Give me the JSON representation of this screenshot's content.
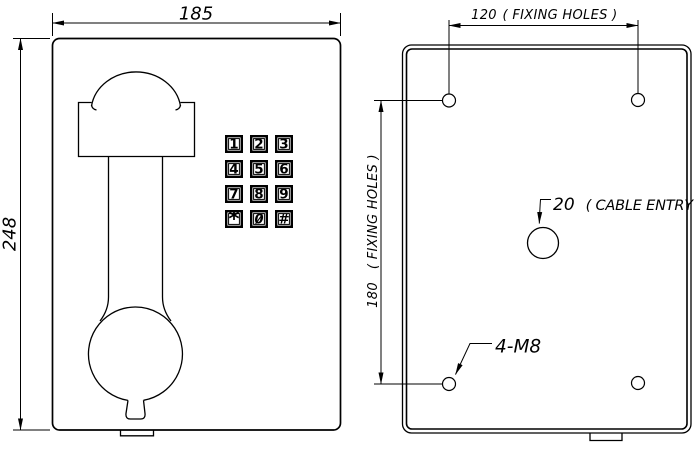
{
  "front_view": {
    "width_dim": "185",
    "height_dim": "248",
    "keypad": [
      "1",
      "2",
      "3",
      "4",
      "5",
      "6",
      "7",
      "8",
      "9",
      "*",
      "0",
      "#"
    ]
  },
  "rear_view": {
    "fixing_width_value": "120",
    "fixing_width_label": "( FIXING HOLES )",
    "fixing_height_value": "180",
    "fixing_height_label": "( FIXING HOLES )",
    "cable_entry_value": "20",
    "cable_entry_label": "( CABLE ENTRY )",
    "bolt_spec": "4-M8"
  }
}
